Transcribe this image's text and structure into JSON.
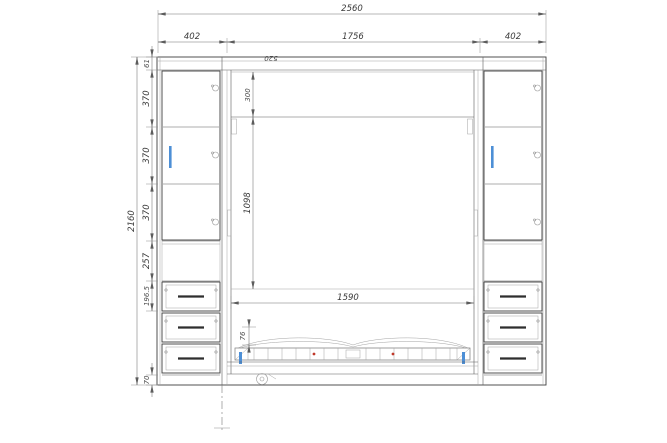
{
  "drawing": {
    "title": "wardrobe-bed-front-elevation",
    "colors": {
      "outline": "#3f3f3f",
      "light_line": "#a3a3a3",
      "dimension_line": "#707070",
      "text": "#3a3a3a",
      "handle_blue": "#4d8fd6",
      "accent_red": "#c0392b"
    },
    "dims": {
      "overall_width": "2560",
      "top_segments": [
        "402",
        "1756",
        "402"
      ],
      "overall_height": "2160",
      "left_chain": [
        "61",
        "370",
        "370",
        "370",
        "257",
        "196.5",
        "70"
      ],
      "top_offset": "300",
      "niche_height": "1098",
      "bed_width": "1590",
      "edge_height": "76",
      "depth_note": "520"
    }
  }
}
